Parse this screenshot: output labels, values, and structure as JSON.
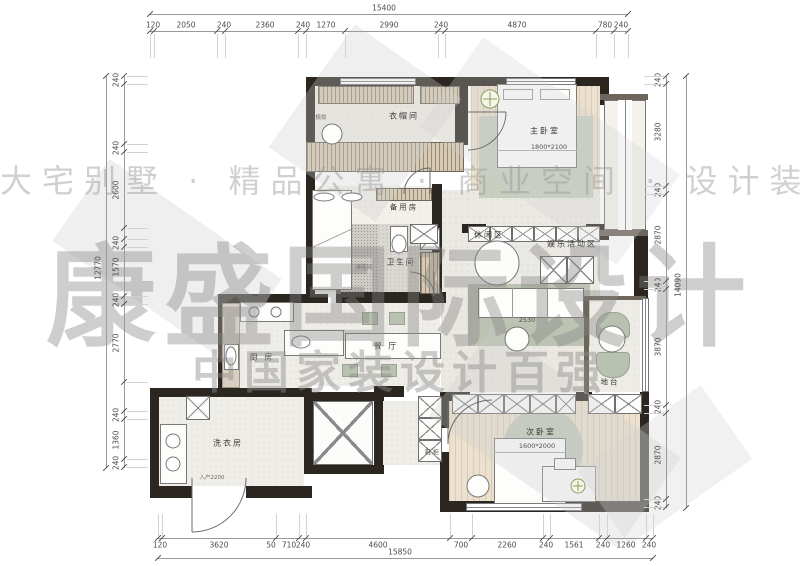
{
  "watermarks": {
    "row1": "大宅别墅 · 精品公寓 · 商业空间 · 设计装修",
    "row2": "康盛国际设计",
    "row3": "中国家装设计百强"
  },
  "dimensions": {
    "top": {
      "overall": "15400",
      "segments": [
        "120",
        "2050",
        "240",
        "2360",
        "240",
        "1270",
        "2990",
        "240",
        "4870",
        "780",
        "240"
      ]
    },
    "bottom": {
      "overall": "15850",
      "segments": [
        "120",
        "3620",
        "50",
        "710",
        "240",
        "4600",
        "700",
        "2260",
        "240",
        "1561",
        "240",
        "1260",
        "240"
      ]
    },
    "left": {
      "overall": "12770",
      "segments": [
        "240",
        "240",
        "2600",
        "240",
        "1570",
        "240",
        "2770",
        "240",
        "1360",
        "240"
      ]
    },
    "right": {
      "overall": "14090",
      "segments": [
        "240",
        "3280",
        "240",
        "2870",
        "240",
        "3870",
        "240",
        "2870",
        "240"
      ]
    }
  },
  "rooms": {
    "cloakroom": "衣帽间",
    "dressing": "梳妆",
    "master_bedroom": "主卧室",
    "master_bed_size": "1800*2100",
    "spare_room": "备用房",
    "bathroom": "卫生间",
    "shower": "淋浴间",
    "leisure": "休闲区",
    "entertainment": "娱乐活动区",
    "kitchen": "厨 房",
    "dining": "餐 厅",
    "sofa_size": "2530",
    "laundry": "洗衣房",
    "entry_label": "入户2200",
    "shoe_cabinet": "鞋 柜",
    "second_bedroom": "次卧室",
    "second_bed_size": "1600*2000",
    "platform": "地台"
  },
  "colors": {
    "wall": "#2b2720",
    "wood_floor": "#ebe1ce",
    "sage": "#b9c1b0",
    "watermark_gray": "#8c8c8c"
  }
}
